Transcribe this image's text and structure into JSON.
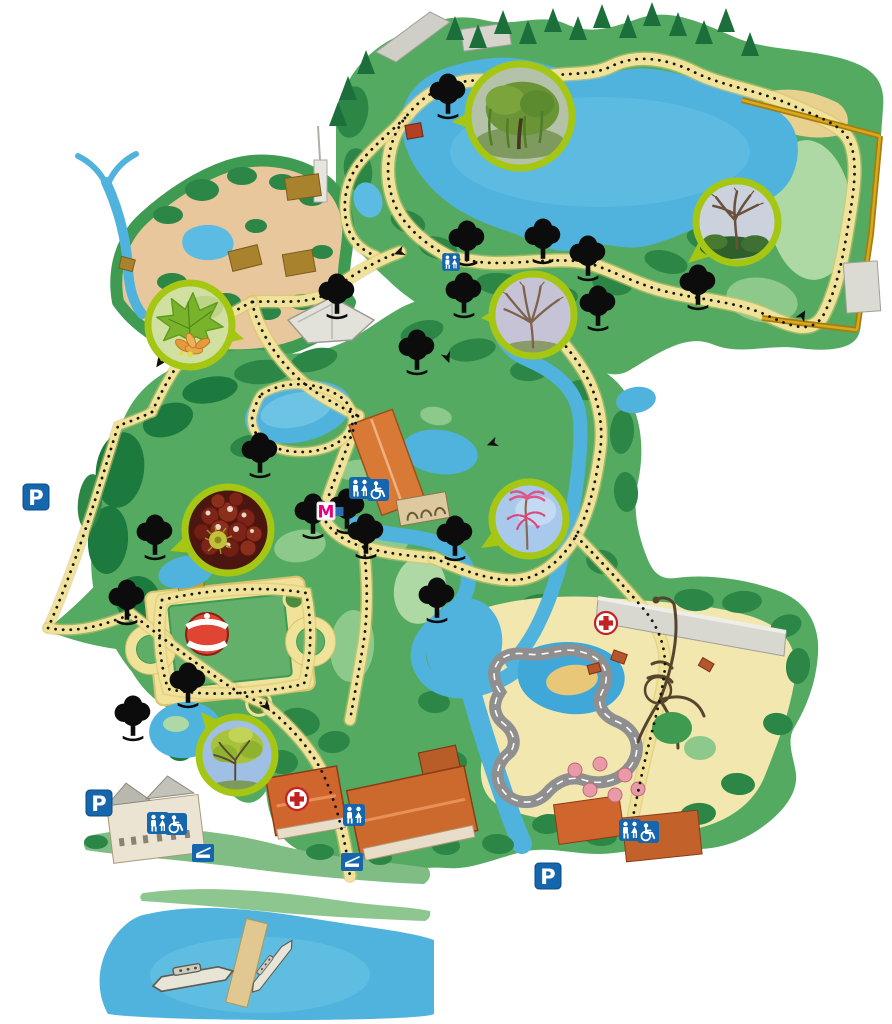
{
  "canvas": {
    "width": 892,
    "height": 1024,
    "background": "#ffffff"
  },
  "labels": {
    "parking": "P",
    "metro": "M"
  },
  "colors": {
    "water": "#4fb3de",
    "water_light": "#6cc3e4",
    "grass": "#55aa62",
    "grass_mid": "#2c8747",
    "woods_dark": "#1d7a3e",
    "grass_light": "#8cc98a",
    "grass_pale": "#aed8a4",
    "savanna": "#e9c79c",
    "path": "#f1e29a",
    "path_edge": "#d9c270",
    "trail_dots": "#141414",
    "inset_border": "#a5c613",
    "sign_blue": "#1566ad",
    "first_aid_red": "#c32222",
    "metro_magenta": "#e6007e",
    "roof_orange": "#d0662e",
    "wall_gold": "#a87d10",
    "carousel_red": "#e04432",
    "track_grey": "#8f8f8f",
    "sand": "#f3e7b0",
    "picnic_pink": "#e89aa8",
    "hut_brown": "#a9822e",
    "boat_hull": "#e7e4d8"
  },
  "markers": {
    "parking": [
      [
        36,
        497
      ],
      [
        99,
        803
      ],
      [
        548,
        876
      ]
    ],
    "toilets": [
      [
        451,
        262,
        0.8
      ],
      [
        360,
        488,
        1
      ],
      [
        354,
        815,
        1
      ],
      [
        158,
        823,
        1
      ],
      [
        630,
        830,
        1
      ]
    ],
    "accessible": [
      [
        378,
        490,
        1
      ],
      [
        176,
        824,
        1
      ],
      [
        648,
        832,
        1
      ]
    ],
    "first_aid": [
      [
        606,
        623
      ],
      [
        297,
        799
      ]
    ],
    "metro": [
      [
        326,
        511
      ]
    ],
    "dock": [
      [
        352,
        862
      ],
      [
        203,
        853
      ]
    ]
  },
  "trees": [
    [
      448,
      100
    ],
    [
      467,
      247
    ],
    [
      543,
      245
    ],
    [
      588,
      262
    ],
    [
      698,
      291
    ],
    [
      337,
      300
    ],
    [
      464,
      299
    ],
    [
      417,
      356
    ],
    [
      260,
      459
    ],
    [
      313,
      520
    ],
    [
      347,
      515
    ],
    [
      366,
      540
    ],
    [
      455,
      542
    ],
    [
      437,
      604
    ],
    [
      155,
      541
    ],
    [
      127,
      606
    ],
    [
      188,
      689
    ],
    [
      133,
      722
    ],
    [
      598,
      312
    ]
  ],
  "boats": [
    {
      "x": 192,
      "y": 977,
      "angle": -10,
      "sx": 1.25,
      "sy": 1.1
    },
    {
      "x": 271,
      "y": 966,
      "angle": -52,
      "sx": 1.0,
      "sy": 0.7
    }
  ],
  "photo_insets": [
    {
      "kind": "willow",
      "label": "weeping willow in leaf",
      "cx": 520,
      "cy": 116,
      "r": 55,
      "tail": [
        452,
        122
      ]
    },
    {
      "kind": "bare_oak",
      "label": "bare winter tree",
      "cx": 737,
      "cy": 222,
      "r": 44,
      "tail": [
        688,
        263
      ]
    },
    {
      "kind": "leaf_seeds",
      "label": "green leaf with seed pods",
      "cx": 190,
      "cy": 325,
      "r": 45,
      "tail": [
        244,
        339
      ]
    },
    {
      "kind": "bare_tree",
      "label": "bare winter tree",
      "cx": 533,
      "cy": 315,
      "r": 44,
      "tail": [
        481,
        318
      ]
    },
    {
      "kind": "chestnuts",
      "label": "horse chestnuts with husk",
      "cx": 228,
      "cy": 530,
      "r": 46,
      "tail": [
        170,
        551
      ]
    },
    {
      "kind": "pink_plant",
      "label": "pink flowering plant",
      "cx": 529,
      "cy": 519,
      "r": 40,
      "tail": [
        481,
        548
      ]
    },
    {
      "kind": "spring_tree",
      "label": "budding spring tree",
      "cx": 237,
      "cy": 755,
      "r": 41,
      "tail": [
        201,
        712
      ]
    }
  ],
  "trail_arrows": [
    [
      400,
      252,
      250
    ],
    [
      447,
      357,
      160
    ],
    [
      540,
      318,
      330
    ],
    [
      802,
      316,
      30
    ],
    [
      266,
      706,
      140
    ],
    [
      631,
      826,
      185
    ],
    [
      160,
      362,
      215
    ],
    [
      493,
      443,
      250
    ]
  ]
}
